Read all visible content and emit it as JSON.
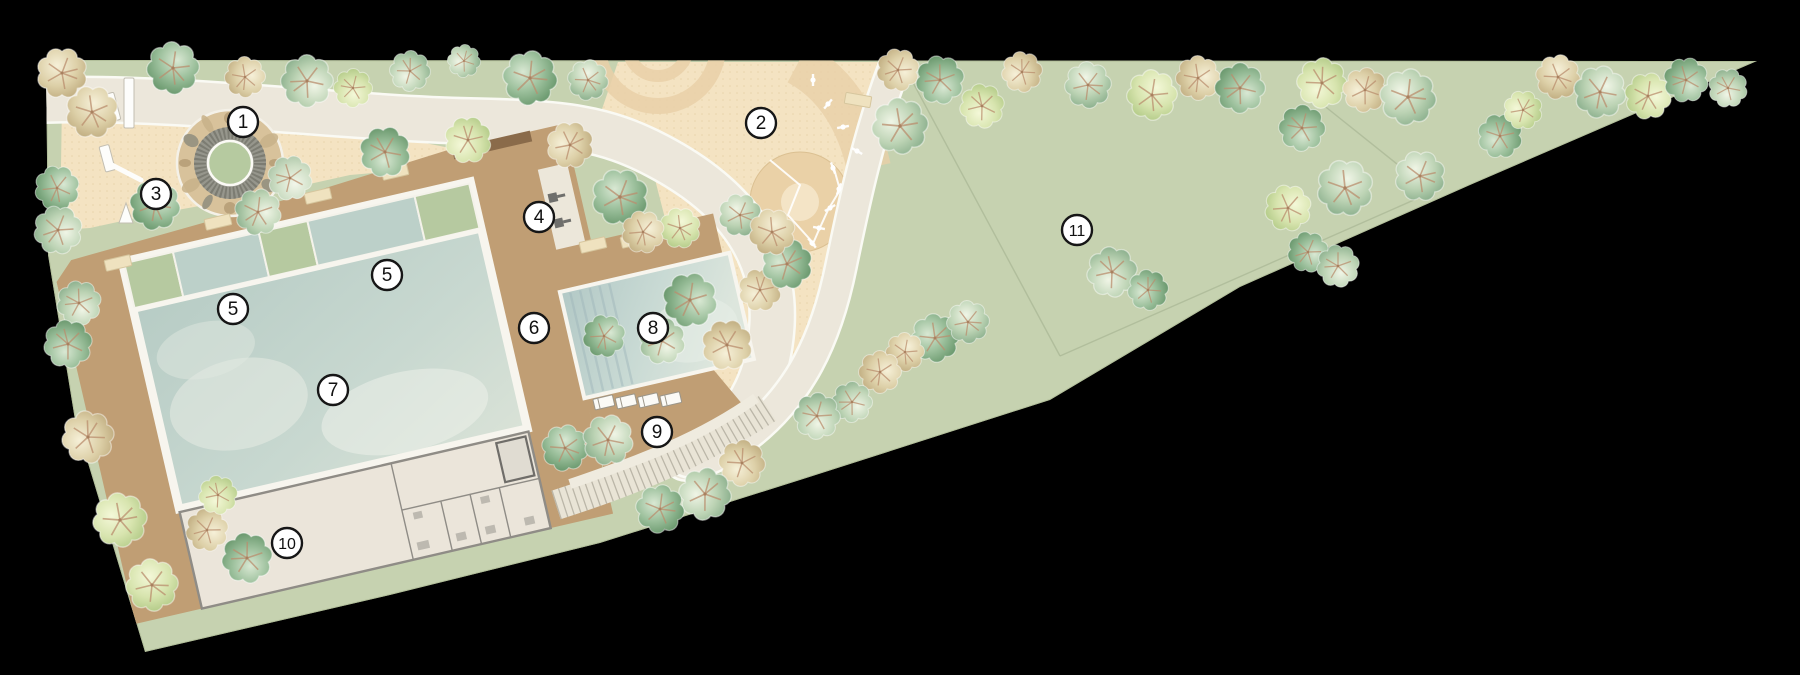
{
  "plan": {
    "type": "landscape-site-plan",
    "background_color": "#000000",
    "markers": [
      {
        "label": "1",
        "x": 243,
        "y": 122
      },
      {
        "label": "2",
        "x": 761,
        "y": 123
      },
      {
        "label": "3",
        "x": 156,
        "y": 194
      },
      {
        "label": "4",
        "x": 539,
        "y": 217
      },
      {
        "label": "5",
        "x": 233,
        "y": 309
      },
      {
        "label": "5",
        "x": 387,
        "y": 275
      },
      {
        "label": "6",
        "x": 534,
        "y": 328
      },
      {
        "label": "7",
        "x": 333,
        "y": 390
      },
      {
        "label": "8",
        "x": 653,
        "y": 328
      },
      {
        "label": "9",
        "x": 657,
        "y": 432
      },
      {
        "label": "10",
        "x": 287,
        "y": 543
      },
      {
        "label": "11",
        "x": 1077,
        "y": 230
      }
    ],
    "colors": {
      "lawn": "#c6d2b0",
      "lawn_edge": "#b2bf9a",
      "sand": "#f4e3c2",
      "sand_deco": "#e9d0a8",
      "path": "#ece7db",
      "path_edge": "#fafaf4",
      "deck": "#c09e74",
      "pool": "#c2d5cd",
      "pool_frame": "#f7f5ee",
      "splash_green": "#b6c9a0",
      "building": "#ebe5da",
      "building_wall": "#8f8c86",
      "stairs": "#e9e4d6",
      "stairs_tick": "#a7a294",
      "marker_fill": "#ffffff",
      "marker_stroke": "#161616"
    },
    "trees": [
      {
        "x": 62,
        "y": 73,
        "r": 26,
        "t": "olive"
      },
      {
        "x": 92,
        "y": 112,
        "r": 27,
        "t": "olive"
      },
      {
        "x": 57,
        "y": 188,
        "r": 23,
        "t": "dark"
      },
      {
        "x": 58,
        "y": 230,
        "r": 25,
        "t": "green"
      },
      {
        "x": 79,
        "y": 303,
        "r": 23,
        "t": "green"
      },
      {
        "x": 68,
        "y": 344,
        "r": 25,
        "t": "dark"
      },
      {
        "x": 88,
        "y": 437,
        "r": 27,
        "t": "olive"
      },
      {
        "x": 120,
        "y": 520,
        "r": 28,
        "t": "lime"
      },
      {
        "x": 152,
        "y": 585,
        "r": 27,
        "t": "lime"
      },
      {
        "x": 173,
        "y": 68,
        "r": 27,
        "t": "dark"
      },
      {
        "x": 245,
        "y": 77,
        "r": 21,
        "t": "olive"
      },
      {
        "x": 307,
        "y": 81,
        "r": 27,
        "t": "green"
      },
      {
        "x": 353,
        "y": 88,
        "r": 20,
        "t": "lime"
      },
      {
        "x": 410,
        "y": 71,
        "r": 21,
        "t": "green"
      },
      {
        "x": 464,
        "y": 61,
        "r": 17,
        "t": "green"
      },
      {
        "x": 530,
        "y": 78,
        "r": 28,
        "t": "dark"
      },
      {
        "x": 588,
        "y": 80,
        "r": 21,
        "t": "green"
      },
      {
        "x": 155,
        "y": 205,
        "r": 26,
        "t": "dark"
      },
      {
        "x": 258,
        "y": 212,
        "r": 24,
        "t": "green"
      },
      {
        "x": 290,
        "y": 178,
        "r": 23,
        "t": "pale"
      },
      {
        "x": 385,
        "y": 152,
        "r": 26,
        "t": "dark"
      },
      {
        "x": 468,
        "y": 140,
        "r": 24,
        "t": "lime"
      },
      {
        "x": 570,
        "y": 145,
        "r": 24,
        "t": "olive"
      },
      {
        "x": 620,
        "y": 197,
        "r": 29,
        "t": "dark"
      },
      {
        "x": 680,
        "y": 228,
        "r": 21,
        "t": "lime"
      },
      {
        "x": 643,
        "y": 232,
        "r": 22,
        "t": "olive"
      },
      {
        "x": 898,
        "y": 70,
        "r": 22,
        "t": "olive"
      },
      {
        "x": 940,
        "y": 80,
        "r": 25,
        "t": "dark"
      },
      {
        "x": 982,
        "y": 106,
        "r": 23,
        "t": "lime"
      },
      {
        "x": 1022,
        "y": 72,
        "r": 21,
        "t": "olive"
      },
      {
        "x": 900,
        "y": 126,
        "r": 29,
        "t": "green"
      },
      {
        "x": 1088,
        "y": 85,
        "r": 24,
        "t": "green"
      },
      {
        "x": 1152,
        "y": 95,
        "r": 26,
        "t": "lime"
      },
      {
        "x": 1198,
        "y": 78,
        "r": 23,
        "t": "olive"
      },
      {
        "x": 1240,
        "y": 88,
        "r": 26,
        "t": "dark"
      },
      {
        "x": 1302,
        "y": 128,
        "r": 24,
        "t": "dark"
      },
      {
        "x": 1322,
        "y": 83,
        "r": 26,
        "t": "lime"
      },
      {
        "x": 1365,
        "y": 90,
        "r": 23,
        "t": "olive"
      },
      {
        "x": 1408,
        "y": 97,
        "r": 29,
        "t": "green"
      },
      {
        "x": 1558,
        "y": 77,
        "r": 23,
        "t": "olive"
      },
      {
        "x": 1600,
        "y": 92,
        "r": 27,
        "t": "green"
      },
      {
        "x": 1648,
        "y": 96,
        "r": 24,
        "t": "lime"
      },
      {
        "x": 1686,
        "y": 80,
        "r": 23,
        "t": "dark"
      },
      {
        "x": 1728,
        "y": 88,
        "r": 20,
        "t": "green"
      },
      {
        "x": 1500,
        "y": 136,
        "r": 23,
        "t": "dark"
      },
      {
        "x": 1523,
        "y": 110,
        "r": 20,
        "t": "lime"
      },
      {
        "x": 1420,
        "y": 176,
        "r": 26,
        "t": "green"
      },
      {
        "x": 1345,
        "y": 188,
        "r": 29,
        "t": "green"
      },
      {
        "x": 1288,
        "y": 208,
        "r": 24,
        "t": "lime"
      },
      {
        "x": 1308,
        "y": 252,
        "r": 21,
        "t": "dark"
      },
      {
        "x": 1338,
        "y": 266,
        "r": 22,
        "t": "green"
      },
      {
        "x": 1112,
        "y": 272,
        "r": 26,
        "t": "green"
      },
      {
        "x": 1148,
        "y": 290,
        "r": 21,
        "t": "dark"
      },
      {
        "x": 935,
        "y": 338,
        "r": 25,
        "t": "dark"
      },
      {
        "x": 968,
        "y": 322,
        "r": 22,
        "t": "green"
      },
      {
        "x": 905,
        "y": 352,
        "r": 20,
        "t": "olive"
      },
      {
        "x": 880,
        "y": 372,
        "r": 22,
        "t": "olive"
      },
      {
        "x": 852,
        "y": 402,
        "r": 21,
        "t": "green"
      },
      {
        "x": 817,
        "y": 416,
        "r": 24,
        "t": "green"
      },
      {
        "x": 742,
        "y": 463,
        "r": 24,
        "t": "olive"
      },
      {
        "x": 705,
        "y": 494,
        "r": 27,
        "t": "green"
      },
      {
        "x": 660,
        "y": 509,
        "r": 25,
        "t": "dark"
      },
      {
        "x": 565,
        "y": 448,
        "r": 24,
        "t": "dark"
      },
      {
        "x": 608,
        "y": 440,
        "r": 26,
        "t": "green"
      },
      {
        "x": 690,
        "y": 300,
        "r": 28,
        "t": "dark"
      },
      {
        "x": 662,
        "y": 341,
        "r": 24,
        "t": "green"
      },
      {
        "x": 727,
        "y": 345,
        "r": 26,
        "t": "olive"
      },
      {
        "x": 760,
        "y": 290,
        "r": 22,
        "t": "olive"
      },
      {
        "x": 787,
        "y": 264,
        "r": 26,
        "t": "dark"
      },
      {
        "x": 740,
        "y": 215,
        "r": 22,
        "t": "green"
      },
      {
        "x": 772,
        "y": 232,
        "r": 24,
        "t": "olive"
      },
      {
        "x": 604,
        "y": 336,
        "r": 22,
        "t": "dark"
      },
      {
        "x": 207,
        "y": 530,
        "r": 22,
        "t": "olive"
      },
      {
        "x": 247,
        "y": 558,
        "r": 26,
        "t": "dark"
      },
      {
        "x": 218,
        "y": 495,
        "r": 20,
        "t": "lime"
      }
    ],
    "benches": [
      {
        "x": 118,
        "y": 263,
        "rot": -13
      },
      {
        "x": 218,
        "y": 222,
        "rot": -13
      },
      {
        "x": 318,
        "y": 196,
        "rot": -13
      },
      {
        "x": 395,
        "y": 172,
        "rot": -13
      },
      {
        "x": 593,
        "y": 245,
        "rot": -13
      },
      {
        "x": 634,
        "y": 240,
        "rot": -13
      },
      {
        "x": 858,
        "y": 100,
        "rot": 10
      }
    ],
    "loungers": [
      {
        "u": 426,
        "v": 190
      },
      {
        "u": 448,
        "v": 194
      },
      {
        "u": 470,
        "v": 198
      },
      {
        "u": 492,
        "v": 202
      }
    ],
    "equipment_stations": [
      {
        "x": 813,
        "y": 80
      },
      {
        "x": 828,
        "y": 104
      },
      {
        "x": 843,
        "y": 127
      },
      {
        "x": 857,
        "y": 151
      },
      {
        "x": 833,
        "y": 168
      },
      {
        "x": 839,
        "y": 189
      },
      {
        "x": 830,
        "y": 208
      },
      {
        "x": 819,
        "y": 228
      },
      {
        "x": 812,
        "y": 243
      }
    ],
    "equipment_lines": [
      "770,160 800,185 788,215 815,245",
      "833,165 840,190 828,210 818,232 812,246"
    ],
    "playground_items": [
      {
        "kind": "rect",
        "x": 103,
        "y": 95,
        "w": 11,
        "h": 28,
        "rot": -15
      },
      {
        "kind": "rect",
        "x": 124,
        "y": 78,
        "w": 10,
        "h": 50,
        "rot": 0
      },
      {
        "kind": "rect",
        "x": 99,
        "y": 147,
        "w": 10,
        "h": 26,
        "rot": -15
      },
      {
        "kind": "bar",
        "x1": 108,
        "y1": 163,
        "x2": 141,
        "y2": 180
      },
      {
        "kind": "tri",
        "x": 126,
        "y": 203
      }
    ],
    "field_lines": [
      [
        903,
        64,
        1060,
        356
      ],
      [
        1060,
        356,
        1432,
        192
      ],
      [
        1432,
        192,
        1312,
        96
      ]
    ],
    "pebble_ring": {
      "cx": 230,
      "cy": 163,
      "r": 45,
      "count": 12
    }
  }
}
